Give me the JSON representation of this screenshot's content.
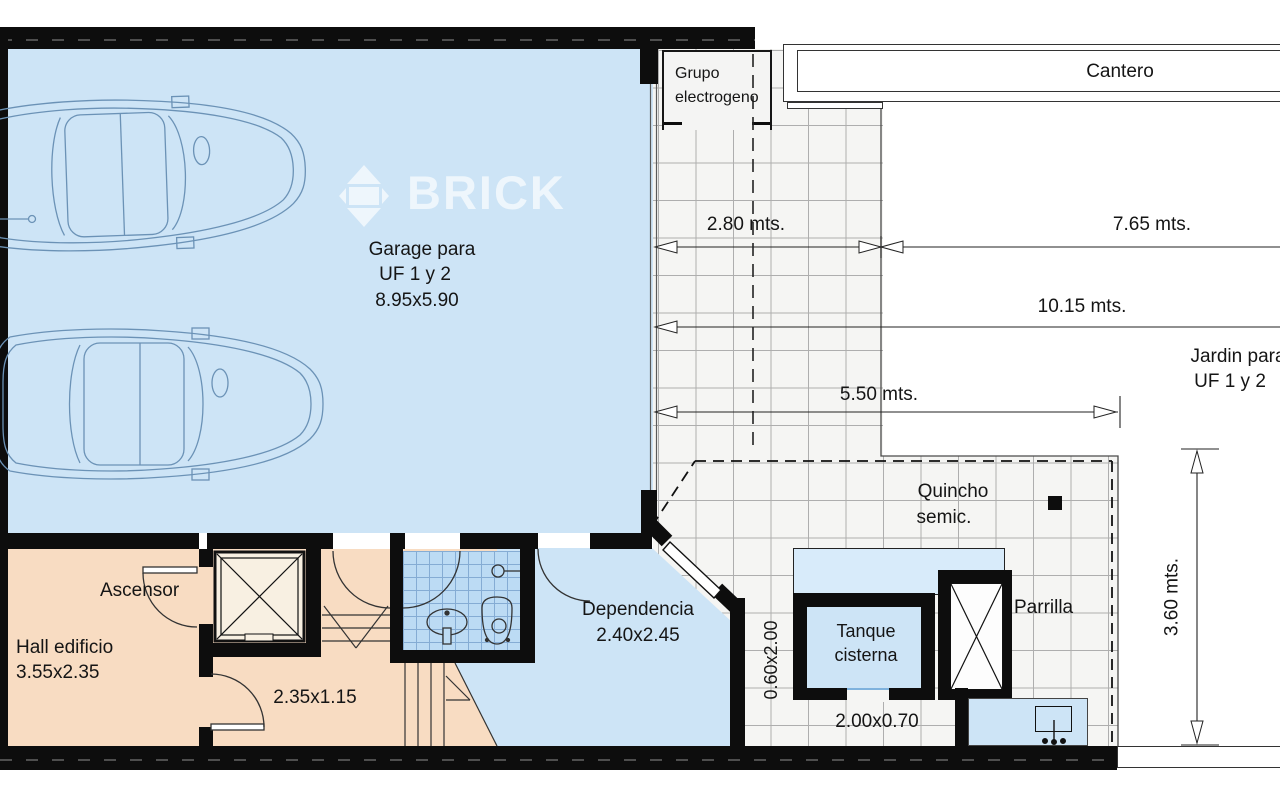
{
  "colors": {
    "garage_floor": "#cde4f6",
    "hall_floor": "#f8dcc2",
    "bath_tile": "#bcdbf4",
    "patio_tile": "#f5f5f3",
    "wall": "#0d0d0d",
    "car_line": "#6b92b6",
    "watermark": "rgba(255,255,255,0.65)"
  },
  "watermark": {
    "brand": "BRICK"
  },
  "labels": {
    "grupo_line1": "Grupo",
    "grupo_line2": "electrogeno",
    "cantero": "Cantero",
    "garage_line1": "Garage para",
    "garage_line2": "UF 1 y 2",
    "garage_line3": "8.95x5.90",
    "jardin_line1": "Jardin para",
    "jardin_line2": "UF 1 y 2",
    "quincho_line1": "Quincho",
    "quincho_line2": "semic.",
    "parrilla": "Parrilla",
    "tanque_line1": "Tanque",
    "tanque_line2": "cisterna",
    "tanque_size": "2.00x0.70",
    "dependencia_line1": "Dependencia",
    "dependencia_line2": "2.40x2.45",
    "ascensor": "Ascensor",
    "hall_line1": "Hall edificio",
    "hall_line2": "3.55x2.35",
    "pasillo": "2.35x1.15",
    "lavadero": "0.60x2.00"
  },
  "dimensions": {
    "path_width": "2.80 mts.",
    "cantero_width": "7.65 mts.",
    "total_width": "10.15 mts.",
    "patio_width": "5.50 mts.",
    "jardin_depth": "3.60 mts."
  }
}
